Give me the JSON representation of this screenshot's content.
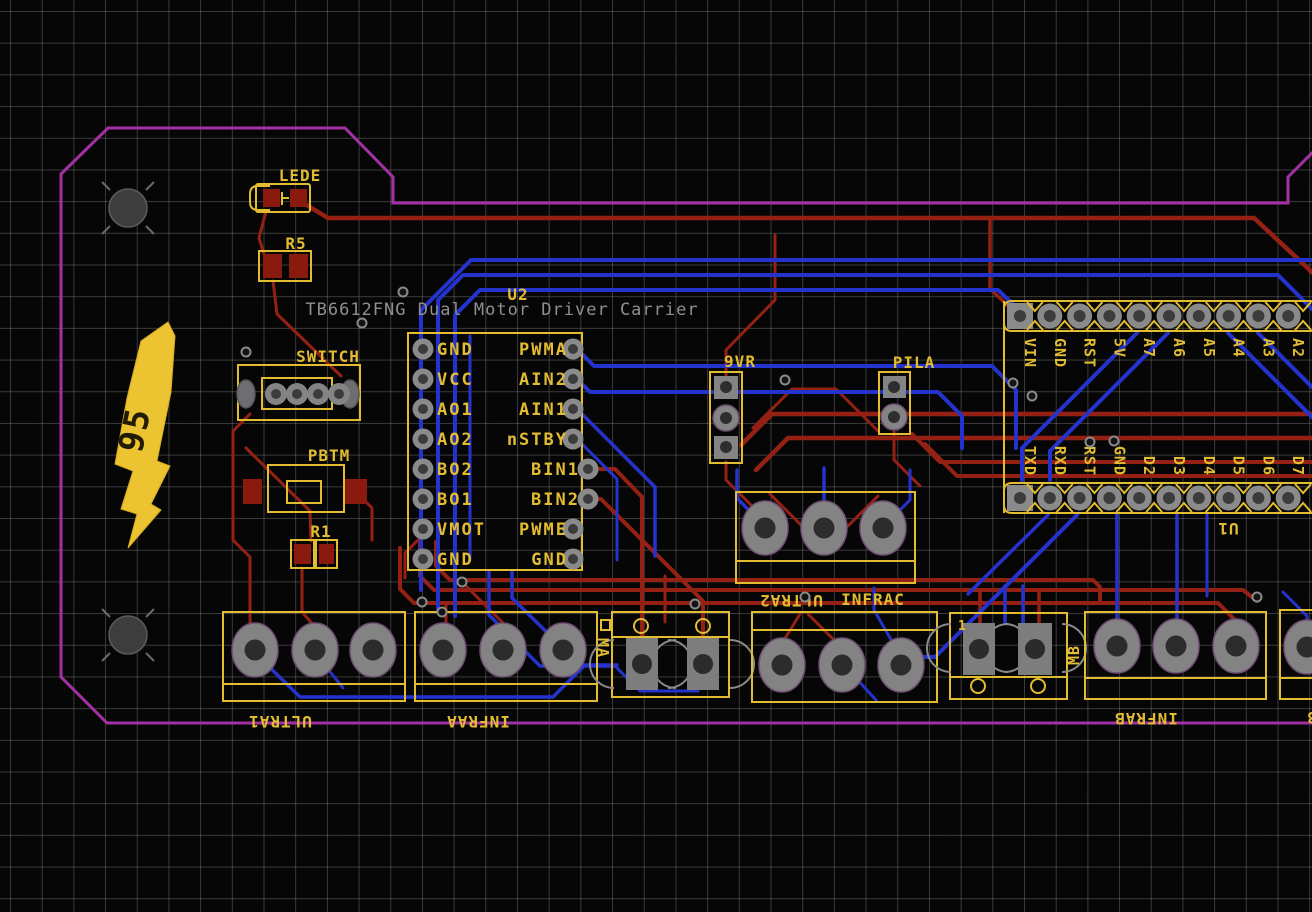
{
  "pcb": {
    "fab_note": "TB6612FNG Dual Motor Driver Carrier",
    "logo": {
      "text": "95"
    },
    "refs": {
      "lede": "LEDE",
      "r5": "R5",
      "switch": "SWITCH",
      "pbtm": "PBTM",
      "r1": "R1",
      "u2": "U2",
      "u1": "U1",
      "vr9": "9VR",
      "pila": "PILA",
      "ultra1": "ULTRA1",
      "infraa": "INFRAA",
      "ma": "MA",
      "ultra2": "ULTRA2",
      "infrac": "INFRAC",
      "mb": "MB",
      "infrab": "INFRAB",
      "ultra3": "ULTRA3",
      "pin1_mark": "1"
    },
    "u2_pins": {
      "left": [
        "GND",
        "VCC",
        "AO1",
        "AO2",
        "BO2",
        "BO1",
        "VMOT",
        "GND"
      ],
      "right": [
        "PWMA",
        "AIN2",
        "AIN1",
        "nSTBY",
        "BIN1",
        "BIN2",
        "PWME",
        "GND"
      ]
    },
    "u1_pins": {
      "top": [
        "VIN",
        "GND",
        "RST",
        "5V",
        "A7",
        "A6",
        "A5",
        "A4",
        "A3",
        "A2"
      ],
      "bottom": [
        "TXD",
        "RXD",
        "RST",
        "GND",
        "D2",
        "D3",
        "D4",
        "D5",
        "D6",
        "D7"
      ]
    },
    "colors": {
      "board_outline": "#a331a3",
      "trace_top_copper": "#942114",
      "trace_bottom_copper": "#2433cd",
      "silkscreen": "#e2bc31",
      "fab_text": "#8f8f8f",
      "pad_gray": "#848484",
      "pad_smd_red": "#8a190e"
    }
  }
}
